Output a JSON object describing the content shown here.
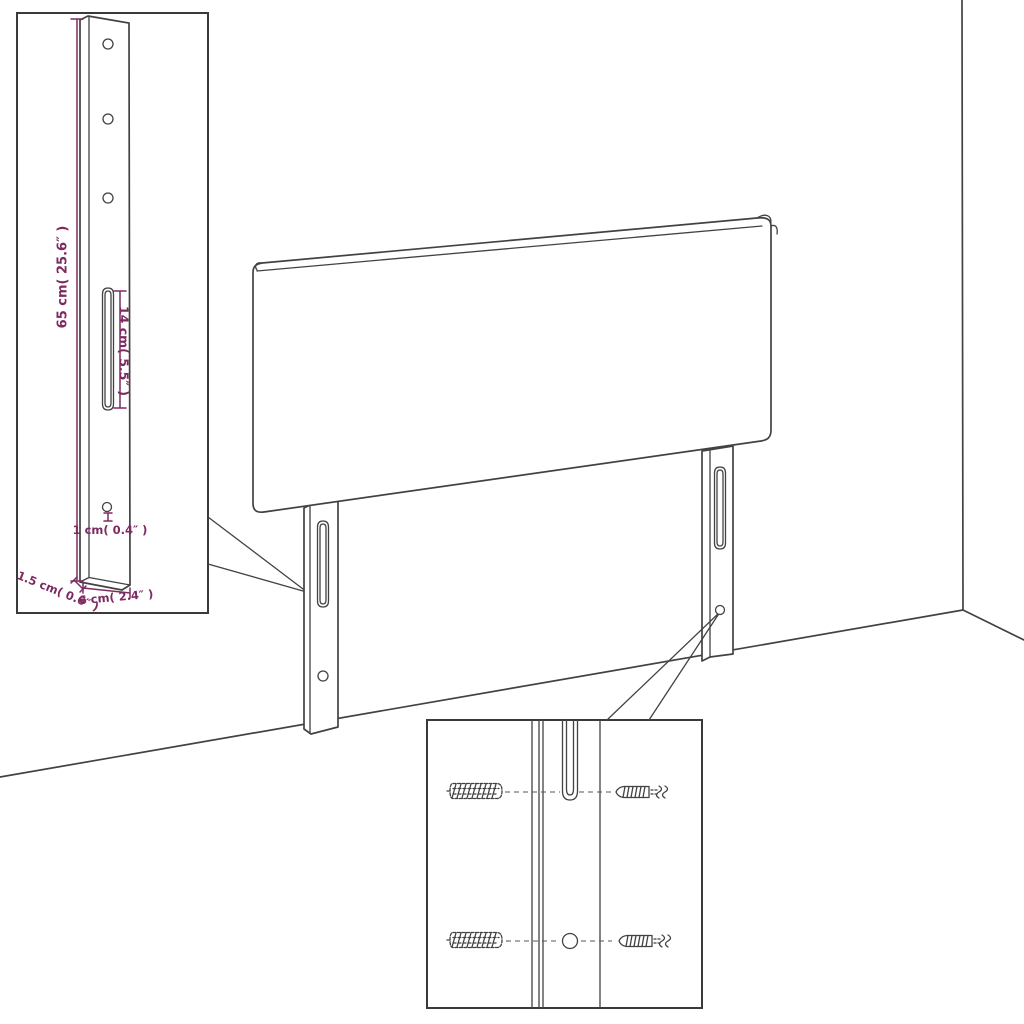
{
  "description": "Assembly dimension diagram of a headboard with two mounting legs standing in a room corner, a magnified bracket inset with dimensions and a wall-plug and screw mounting inset",
  "colors": {
    "background": "#ffffff",
    "line": "#424242",
    "dimension": "#7e2a62"
  },
  "insets": {
    "bracket_detail": {
      "dims": {
        "height_label": "65 cm( 25.6″ )",
        "slot_label": "14 cm( 5.5″ )",
        "hole_label": "1 cm( 0.4″ )",
        "depth_label": "1.5 cm( 0.6″ )",
        "width_label": "6 cm( 2.4″ )"
      }
    },
    "screw_detail": {}
  }
}
